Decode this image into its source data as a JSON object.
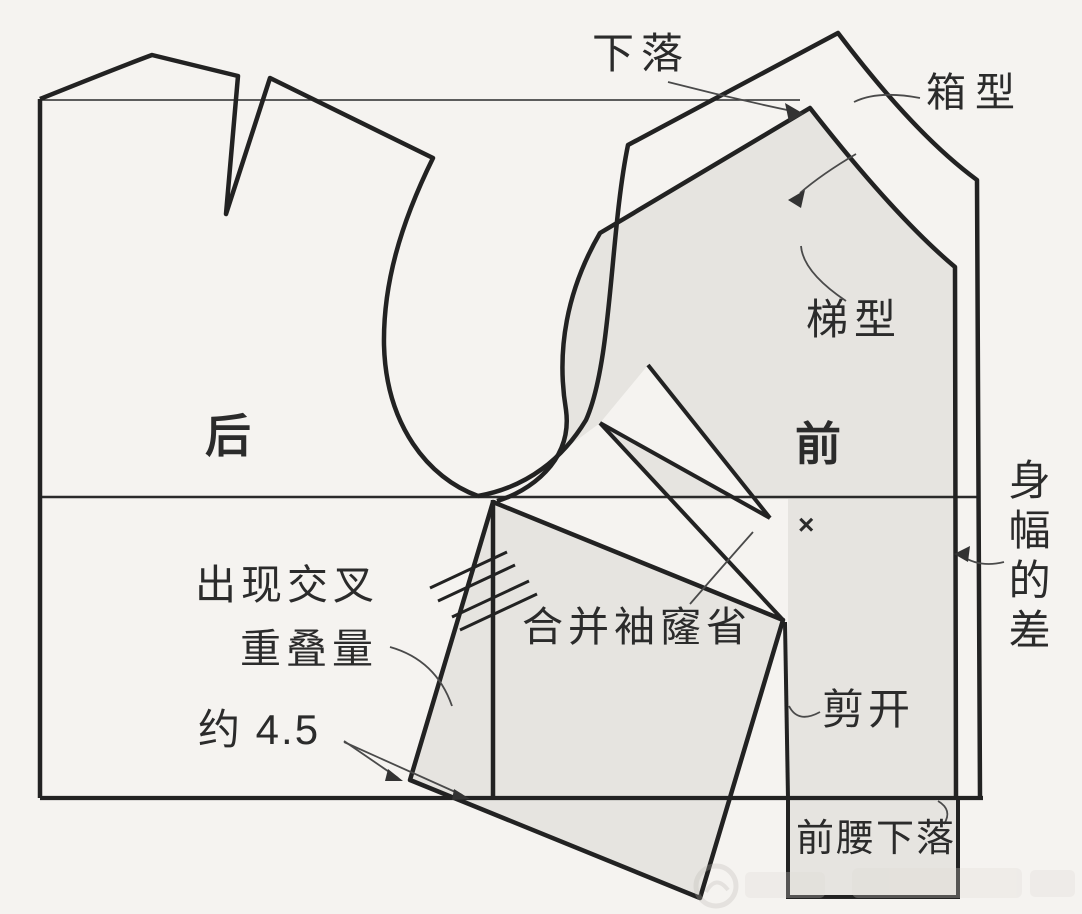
{
  "diagram": {
    "kind": "sewing-pattern-drafting",
    "labels": {
      "drop": "下落",
      "box_type": "箱型",
      "trapezoid_type": "梯型",
      "back": "后",
      "front": "前",
      "body_width_difference": "身幅的差",
      "cross_appears": "出现交叉",
      "overlap_amount": "重叠量",
      "approx_value": "约 4.5",
      "merge_armhole_dart": "合并袖窿省",
      "cut_open": "剪开",
      "front_waist_drop": "前腰下落",
      "bust_point_mark": "×"
    },
    "colors": {
      "background": "#f5f3f0",
      "outline": "#222222",
      "shaded_piece": "#e6e4e0",
      "leader_line": "#4a4a4a"
    }
  }
}
